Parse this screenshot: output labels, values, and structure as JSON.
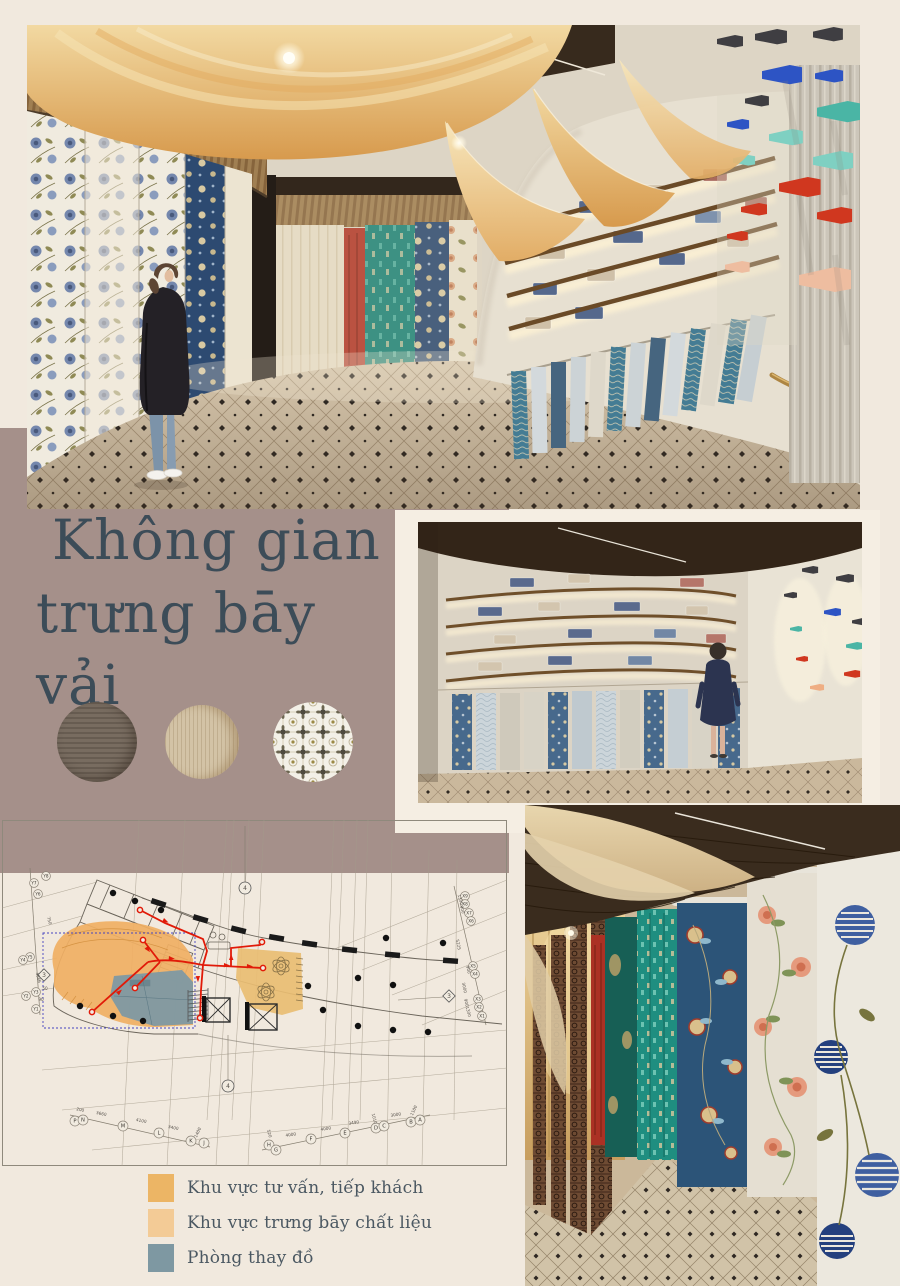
{
  "title": {
    "line1": "Không gian",
    "line2": "trưng bāy vải"
  },
  "materials": [
    {
      "name": "dark-wood-laminate"
    },
    {
      "name": "light-oak-veneer"
    },
    {
      "name": "patterned-ceramic-tile"
    }
  ],
  "legend": {
    "items": [
      {
        "label": "Khu vực tư vấn, tiếp khách",
        "color": "#ecb565"
      },
      {
        "label": "Khu vực trưng bāy chất liệu",
        "color": "#f3cb96"
      },
      {
        "label": "Phòng thay đồ",
        "color": "#7e98a2"
      }
    ]
  },
  "plan": {
    "bubbles": [
      {
        "t": "Y8",
        "x": 44,
        "y": 56
      },
      {
        "t": "Y7",
        "x": 32,
        "y": 63
      },
      {
        "t": "Y6",
        "x": 36,
        "y": 74
      },
      {
        "t": "Y5",
        "x": 28,
        "y": 137
      },
      {
        "t": "Y4",
        "x": 21,
        "y": 140
      },
      {
        "t": "Y3",
        "x": 34,
        "y": 172
      },
      {
        "t": "Y2",
        "x": 24,
        "y": 176
      },
      {
        "t": "Y1",
        "x": 34,
        "y": 189
      },
      {
        "t": "X9",
        "x": 463,
        "y": 76
      },
      {
        "t": "X8",
        "x": 463,
        "y": 84
      },
      {
        "t": "X7",
        "x": 467,
        "y": 93
      },
      {
        "t": "X6",
        "x": 469,
        "y": 101
      },
      {
        "t": "X5",
        "x": 471,
        "y": 146
      },
      {
        "t": "X4",
        "x": 473,
        "y": 154
      },
      {
        "t": "X3",
        "x": 476,
        "y": 179
      },
      {
        "t": "X2",
        "x": 477,
        "y": 187
      },
      {
        "t": "X1",
        "x": 480,
        "y": 196
      },
      {
        "t": "P",
        "x": 73,
        "y": 301
      },
      {
        "t": "N",
        "x": 81,
        "y": 300
      },
      {
        "t": "M",
        "x": 121,
        "y": 306
      },
      {
        "t": "L",
        "x": 157,
        "y": 313
      },
      {
        "t": "K",
        "x": 189,
        "y": 321
      },
      {
        "t": "J",
        "x": 202,
        "y": 323
      },
      {
        "t": "H",
        "x": 267,
        "y": 325
      },
      {
        "t": "G",
        "x": 274,
        "y": 330
      },
      {
        "t": "F",
        "x": 309,
        "y": 319
      },
      {
        "t": "E",
        "x": 343,
        "y": 313
      },
      {
        "t": "D",
        "x": 374,
        "y": 308
      },
      {
        "t": "C",
        "x": 382,
        "y": 306
      },
      {
        "t": "B",
        "x": 409,
        "y": 302
      },
      {
        "t": "A",
        "x": 418,
        "y": 300
      }
    ],
    "dims": [
      {
        "t": "200",
        "x": 78,
        "y": 291,
        "r": 12
      },
      {
        "t": "3660",
        "x": 99,
        "y": 295,
        "r": 12
      },
      {
        "t": "4100",
        "x": 139,
        "y": 302,
        "r": 12
      },
      {
        "t": "3400",
        "x": 171,
        "y": 309,
        "r": 12
      },
      {
        "t": "1400",
        "x": 197,
        "y": 313,
        "r": -65
      },
      {
        "t": "520",
        "x": 266,
        "y": 314,
        "r": 75
      },
      {
        "t": "4000",
        "x": 289,
        "y": 316,
        "r": -9
      },
      {
        "t": "4000",
        "x": 324,
        "y": 310,
        "r": -9
      },
      {
        "t": "3490",
        "x": 352,
        "y": 304,
        "r": -9
      },
      {
        "t": "1010",
        "x": 371,
        "y": 299,
        "r": 75
      },
      {
        "t": "3000",
        "x": 394,
        "y": 296,
        "r": -9
      },
      {
        "t": "1100",
        "x": 413,
        "y": 291,
        "r": -65
      },
      {
        "t": "750",
        "x": 46,
        "y": 101,
        "r": 75
      },
      {
        "t": "4566",
        "x": 35,
        "y": 158,
        "r": 75
      },
      {
        "t": "50",
        "x": 43,
        "y": 170,
        "r": 0
      },
      {
        "t": "90",
        "x": 39,
        "y": 181,
        "r": 0
      },
      {
        "t": "1300",
        "x": 457,
        "y": 80,
        "r": 75
      },
      {
        "t": "900",
        "x": 459,
        "y": 90,
        "r": 75
      },
      {
        "t": "5225",
        "x": 455,
        "y": 125,
        "r": 78
      },
      {
        "t": "900",
        "x": 465,
        "y": 150,
        "r": 78
      },
      {
        "t": "3000",
        "x": 461,
        "y": 168,
        "r": 78
      },
      {
        "t": "900",
        "x": 463,
        "y": 183,
        "r": 78
      },
      {
        "t": "1300",
        "x": 465,
        "y": 192,
        "r": 75
      }
    ],
    "refs": [
      {
        "t": "4",
        "x": 243,
        "y": 68,
        "shape": "c"
      },
      {
        "t": "4",
        "x": 226,
        "y": 266,
        "shape": "c"
      },
      {
        "t": "3",
        "x": 447,
        "y": 176,
        "shape": "d"
      },
      {
        "t": "3",
        "x": 42,
        "y": 155,
        "shape": "d"
      }
    ]
  },
  "palette": {
    "page_bg": "#f1e9de",
    "mauve_block": "#a5908a",
    "title_text": "#3c4c58",
    "legend_text": "#4b5862",
    "plan_route": "#e11a08",
    "plan_zone_consult": "#f0af63",
    "plan_zone_display": "#e9bd72",
    "plan_zone_fitting": "#7e99a3"
  }
}
